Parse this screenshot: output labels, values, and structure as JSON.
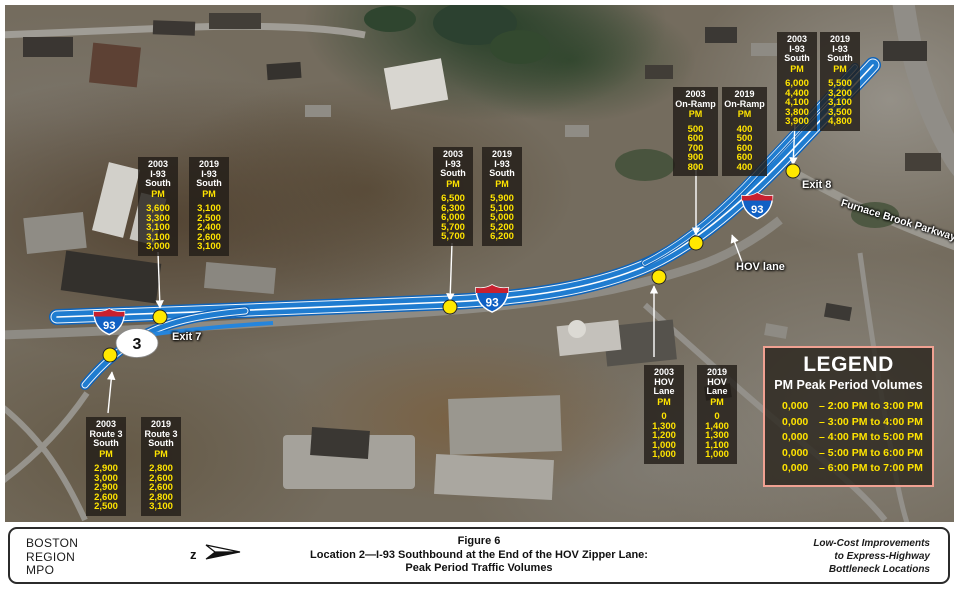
{
  "map_labels": {
    "exit7": "Exit 7",
    "exit8": "Exit 8",
    "hov_lane": "HOV lane",
    "furnace_brook": "Furnace Brook Parkway",
    "i93_shield": "93",
    "route3_shield": "3"
  },
  "callouts": [
    {
      "name": "i93-south-left",
      "columns": [
        {
          "header_lines": [
            "2003",
            "I-93",
            "South"
          ],
          "pm_label": "PM",
          "values": [
            "3,600",
            "3,300",
            "3,100",
            "3,100",
            "3,000"
          ]
        },
        {
          "header_lines": [
            "2019",
            "I-93",
            "South"
          ],
          "pm_label": "PM",
          "values": [
            "3,100",
            "2,500",
            "2,400",
            "2,600",
            "3,100"
          ]
        }
      ]
    },
    {
      "name": "i93-south-middle",
      "columns": [
        {
          "header_lines": [
            "2003",
            "I-93",
            "South"
          ],
          "pm_label": "PM",
          "values": [
            "6,500",
            "6,300",
            "6,000",
            "5,700",
            "5,700"
          ]
        },
        {
          "header_lines": [
            "2019",
            "I-93",
            "South"
          ],
          "pm_label": "PM",
          "values": [
            "5,900",
            "5,100",
            "5,000",
            "5,200",
            "6,200"
          ]
        }
      ]
    },
    {
      "name": "on-ramp",
      "columns": [
        {
          "header_lines": [
            "2003",
            "On-Ramp"
          ],
          "pm_label": "PM",
          "values": [
            "500",
            "600",
            "700",
            "900",
            "800"
          ]
        },
        {
          "header_lines": [
            "2019",
            "On-Ramp"
          ],
          "pm_label": "PM",
          "values": [
            "400",
            "500",
            "600",
            "600",
            "400"
          ]
        }
      ]
    },
    {
      "name": "i93-south-exit8",
      "columns": [
        {
          "header_lines": [
            "2003",
            "I-93",
            "South"
          ],
          "pm_label": "PM",
          "values": [
            "6,000",
            "4,400",
            "4,100",
            "3,800",
            "3,900"
          ]
        },
        {
          "header_lines": [
            "2019",
            "I-93",
            "South"
          ],
          "pm_label": "PM",
          "values": [
            "5,500",
            "3,200",
            "3,100",
            "3,500",
            "4,800"
          ]
        }
      ]
    },
    {
      "name": "route3-south",
      "columns": [
        {
          "header_lines": [
            "2003",
            "Route 3",
            "South"
          ],
          "pm_label": "PM",
          "values": [
            "2,900",
            "3,000",
            "2,900",
            "2,600",
            "2,500"
          ]
        },
        {
          "header_lines": [
            "2019",
            "Route 3",
            "South"
          ],
          "pm_label": "PM",
          "values": [
            "2,800",
            "2,600",
            "2,600",
            "2,800",
            "3,100"
          ]
        }
      ]
    },
    {
      "name": "hov-lane",
      "columns": [
        {
          "header_lines": [
            "2003",
            "HOV",
            "Lane"
          ],
          "pm_label": "PM",
          "values": [
            "0",
            "1,300",
            "1,200",
            "1,000",
            "1,000"
          ]
        },
        {
          "header_lines": [
            "2019",
            "HOV",
            "Lane"
          ],
          "pm_label": "PM",
          "values": [
            "0",
            "1,400",
            "1,300",
            "1,100",
            "1,000"
          ]
        }
      ]
    }
  ],
  "legend": {
    "title": "LEGEND",
    "subtitle": "PM Peak Period Volumes",
    "rows": [
      {
        "value": "0,000",
        "label": "– 2:00 PM to 3:00 PM"
      },
      {
        "value": "0,000",
        "label": "– 3:00 PM to 4:00 PM"
      },
      {
        "value": "0,000",
        "label": "– 4:00 PM to 5:00 PM"
      },
      {
        "value": "0,000",
        "label": "– 5:00 PM to 6:00 PM"
      },
      {
        "value": "0,000",
        "label": "– 6:00 PM to 7:00 PM"
      }
    ]
  },
  "footer": {
    "org_lines": [
      "BOSTON",
      "REGION",
      "MPO"
    ],
    "title_lines": [
      "Figure 6",
      "Location 2—I-93 Southbound at the End of the HOV Zipper Lane:",
      "Peak Period Traffic Volumes"
    ],
    "credit_lines": [
      "Low-Cost Improvements",
      "to Express-Highway",
      "Bottleneck Locations"
    ]
  },
  "colors": {
    "highway_blue": "#1f7cd0",
    "marker_yellow": "#ffe800",
    "value_yellow": "#ffe400",
    "legend_border": "#f0a192",
    "shield_red": "#c8202f",
    "shield_blue": "#1060c4"
  }
}
